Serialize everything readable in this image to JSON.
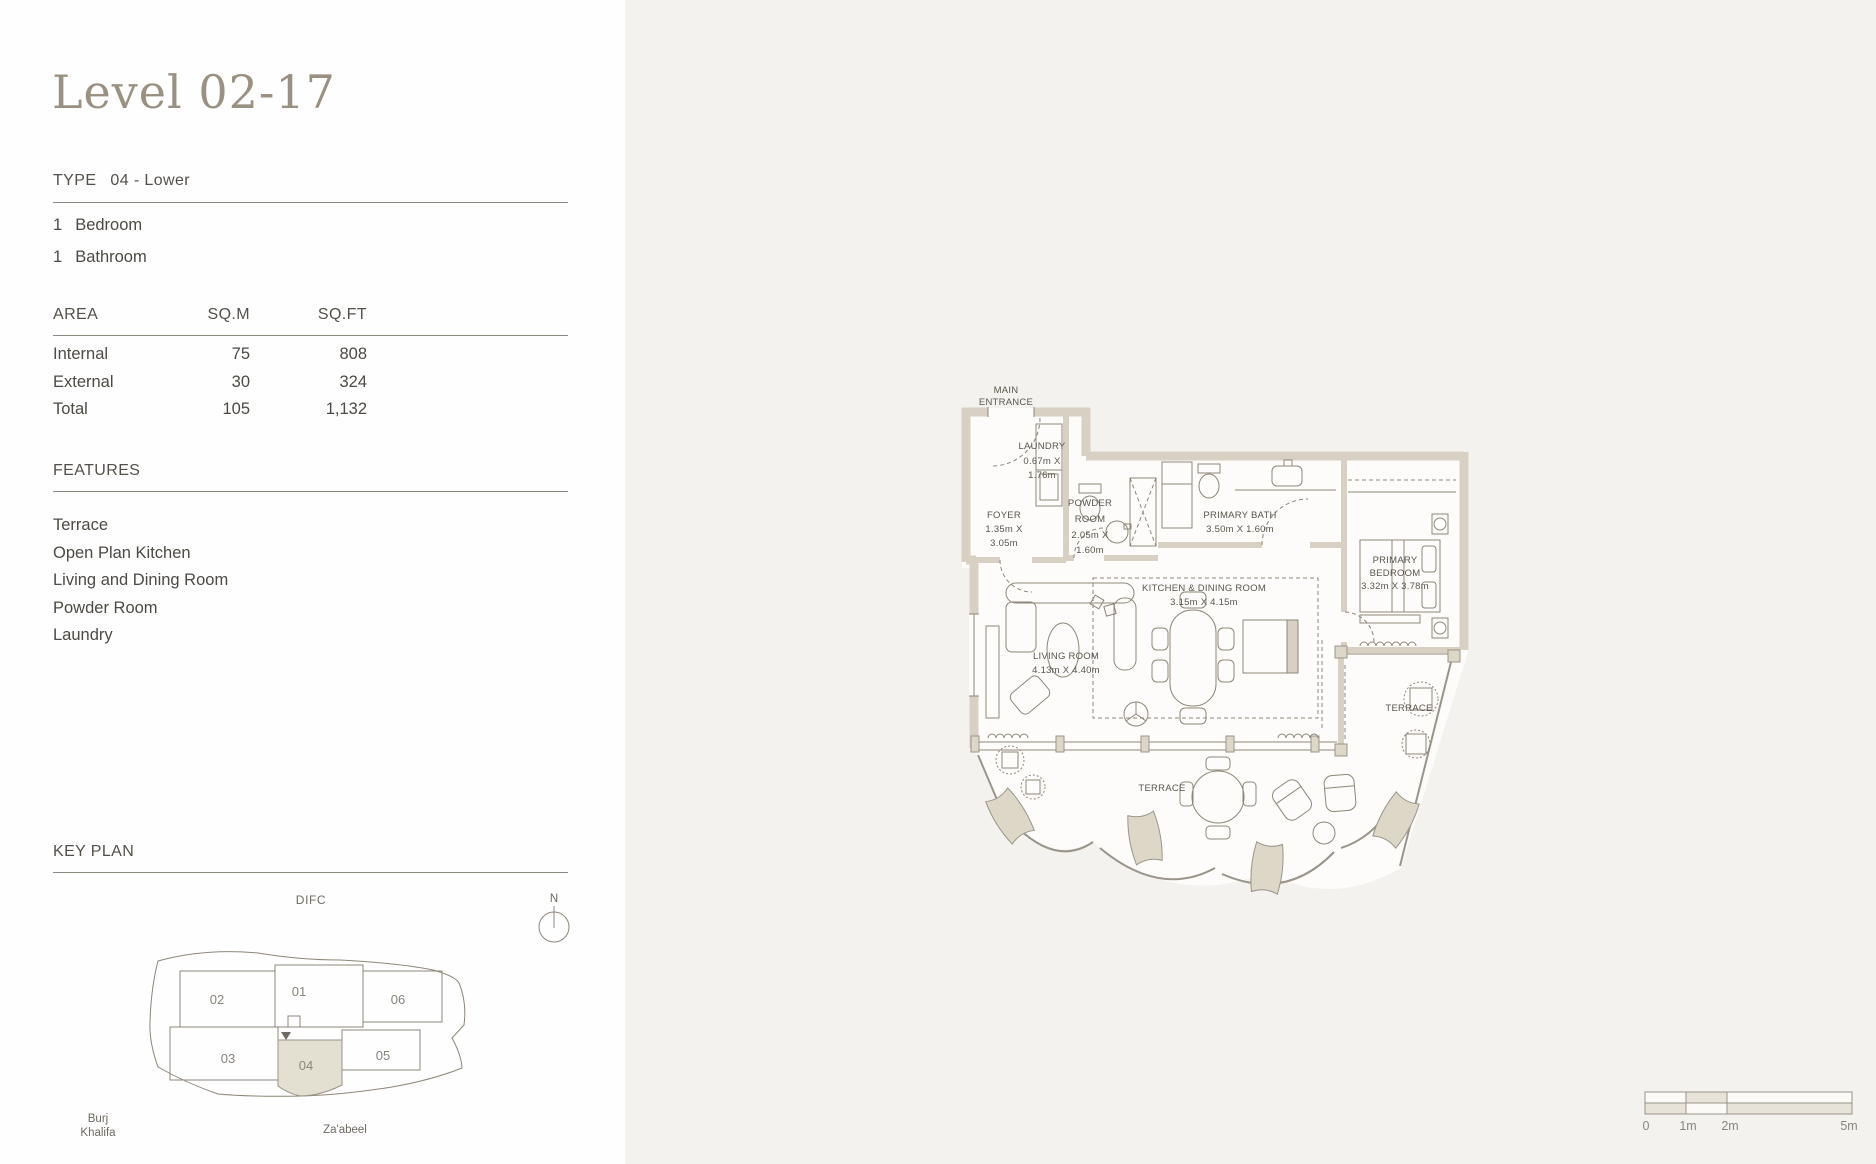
{
  "page": {
    "title": "Level 02-17"
  },
  "colors": {
    "panel": "#fefefe",
    "background": "#f4f2ee",
    "accent_beige": "#d8d1c3",
    "highlight_unit": "#e4e0d1",
    "title_text": "#9b9183",
    "body_text": "#4e4a44",
    "line": "#8e8779"
  },
  "unit": {
    "type_label": "TYPE",
    "type_value": "04 - Lower",
    "rooms": [
      {
        "count": "1",
        "label": "Bedroom"
      },
      {
        "count": "1",
        "label": "Bathroom"
      }
    ]
  },
  "area_table": {
    "col_label": "AREA",
    "col_sqm": "SQ.M",
    "col_sqft": "SQ.FT",
    "rows": [
      {
        "label": "Internal",
        "sqm": "75",
        "sqft": "808"
      },
      {
        "label": "External",
        "sqm": "30",
        "sqft": "324"
      },
      {
        "label": "Total",
        "sqm": "105",
        "sqft": "1,132"
      }
    ]
  },
  "features": {
    "heading": "FEATURES",
    "items": [
      "Terrace",
      "Open Plan Kitchen",
      "Living and Dining Room",
      "Powder Room",
      "Laundry"
    ]
  },
  "key_plan": {
    "heading": "KEY PLAN",
    "area_label": "DIFC",
    "north_label": "N",
    "units": [
      {
        "id": "01"
      },
      {
        "id": "02"
      },
      {
        "id": "03"
      },
      {
        "id": "04"
      },
      {
        "id": "05"
      },
      {
        "id": "06"
      }
    ],
    "highlighted_unit": "04",
    "landmark_left_line1": "Burj",
    "landmark_left_line2": "Khalifa",
    "landmark_bottom": "Za'abeel"
  },
  "floor_plan": {
    "entrance_line1": "MAIN",
    "entrance_line2": "ENTRANCE",
    "rooms": {
      "laundry": {
        "name": "LAUNDRY",
        "dims1": "0.67m X",
        "dims2": "1.76m"
      },
      "foyer": {
        "name": "FOYER",
        "dims1": "1.35m X",
        "dims2": "3.05m"
      },
      "powder": {
        "name1": "POWDER",
        "name2": "ROOM",
        "dims1": "2.05m X",
        "dims2": "1.60m"
      },
      "primary_bath": {
        "name": "PRIMARY BATH",
        "dims": "3.50m X 1.60m"
      },
      "primary_bedroom": {
        "name1": "PRIMARY",
        "name2": "BEDROOM",
        "dims": "3.32m X 3.78m"
      },
      "kitchen": {
        "name": "KITCHEN & DINING ROOM",
        "dims": "3.15m X 4.15m"
      },
      "living": {
        "name": "LIVING ROOM",
        "dims": "4.13m X 4.40m"
      },
      "terrace_right": "TERRACE",
      "terrace_main": "TERRACE"
    }
  },
  "scale_bar": {
    "labels": [
      "0",
      "1m",
      "2m",
      "5m"
    ]
  }
}
